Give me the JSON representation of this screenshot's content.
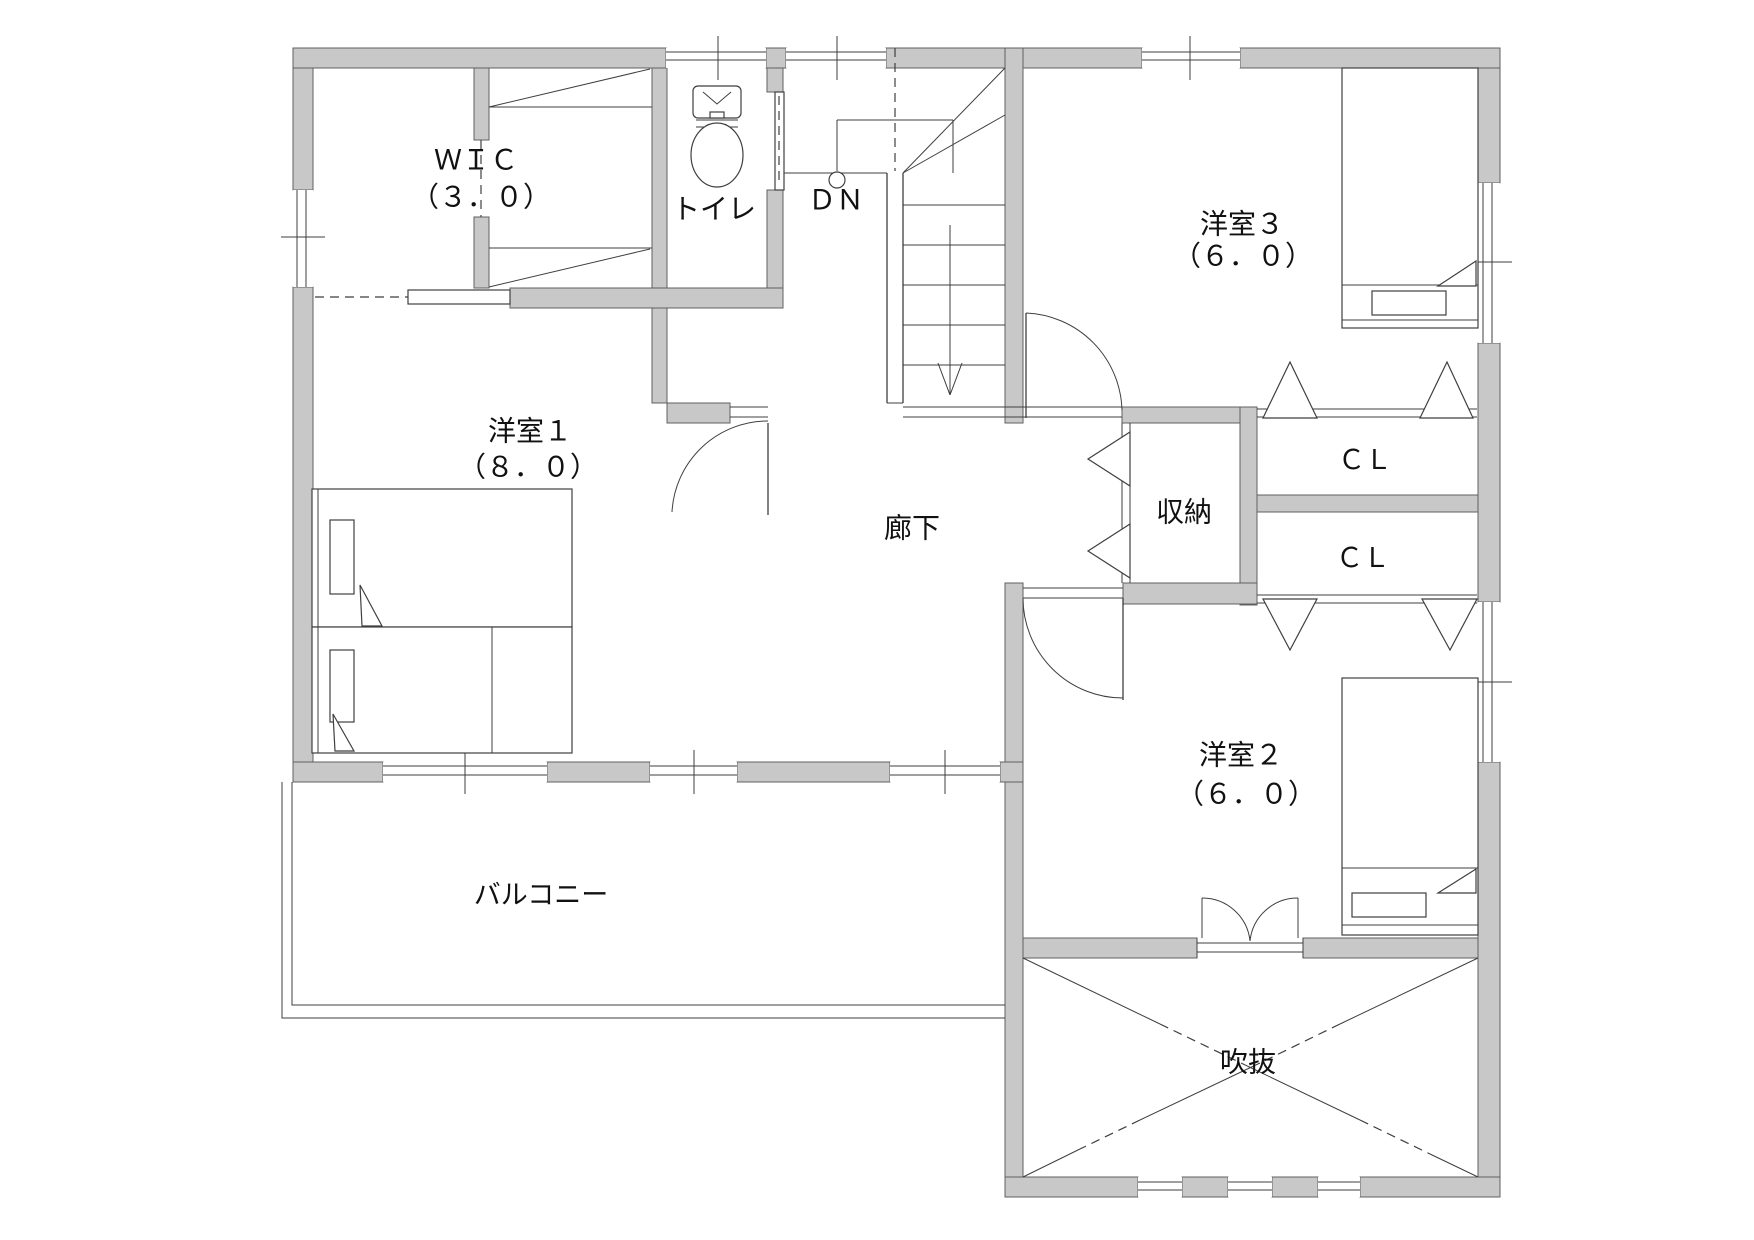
{
  "plan": {
    "floor_label_rooms": [
      {
        "id": "wic",
        "label": "ＷＩＣ",
        "sublabel": "（３．０）"
      },
      {
        "id": "toilet",
        "label": "トイレ"
      },
      {
        "id": "stairs",
        "label": "ＤＮ"
      },
      {
        "id": "room3",
        "label": "洋室３",
        "sublabel": "（６．０）"
      },
      {
        "id": "room1",
        "label": "洋室１",
        "sublabel": "（８．０）"
      },
      {
        "id": "hallway",
        "label": "廊下"
      },
      {
        "id": "storage",
        "label": "収納"
      },
      {
        "id": "closet1",
        "label": "ＣＬ"
      },
      {
        "id": "closet2",
        "label": "ＣＬ"
      },
      {
        "id": "room2",
        "label": "洋室２",
        "sublabel": "（６．０）"
      },
      {
        "id": "balcony",
        "label": "バルコニー"
      },
      {
        "id": "void",
        "label": "吹抜"
      }
    ],
    "colors": {
      "wall": "#c8c8c8",
      "line": "#3f3f3f",
      "background": "#ffffff",
      "text": "#111111"
    }
  }
}
